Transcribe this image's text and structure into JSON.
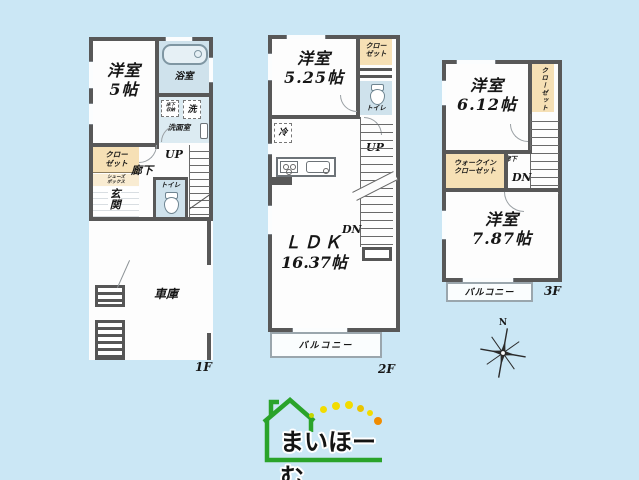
{
  "colors": {
    "bg": "#cbe7f5",
    "wall": "#585858",
    "floor": "#fdfdfd",
    "closet": "#f6e0b5",
    "closet-light": "#f9ecd2",
    "wet": "#cfe2ec",
    "wet-light": "#dcebf2",
    "logo-green": "#2aa32a",
    "dot-lime": "#c3d600",
    "dot-yellow": "#f2dc00",
    "dot-amber": "#eac400",
    "dot-orange": "#f08c00"
  },
  "floor1": {
    "label": "1F",
    "bedroom": {
      "name": "洋室",
      "size": "5帖"
    },
    "bath": "浴室",
    "underfloor_storage": "床下収納",
    "washer": "洗",
    "washroom": "洗面室",
    "closet": "クローゼット",
    "shoe_box": "シューズボックス",
    "entrance": "玄関",
    "hallway": "廊下",
    "stairs_up": "UP",
    "toilet": "トイレ",
    "garage": "車庫"
  },
  "floor2": {
    "label": "2F",
    "bedroom": {
      "name": "洋室",
      "size": "5.25帖"
    },
    "closet": "クローゼット",
    "toilet": "トイレ",
    "fridge": "冷",
    "ldk": {
      "name": "ＬＤＫ",
      "size": "16.37帖"
    },
    "stairs_up": "UP",
    "stairs_down": "DN",
    "balcony": "バルコニー"
  },
  "floor3": {
    "label": "3F",
    "bedroom_a": {
      "name": "洋室",
      "size": "6.12帖"
    },
    "closet": "クローゼット",
    "walk_in_closet": "ウォークインクローゼット",
    "hallway": "廊下",
    "stairs_down": "DN",
    "bedroom_b": {
      "name": "洋室",
      "size": "7.87帖"
    },
    "balcony": "バルコニー"
  },
  "compass": {
    "north": "N"
  },
  "logo": {
    "text": "まいほーむ"
  }
}
